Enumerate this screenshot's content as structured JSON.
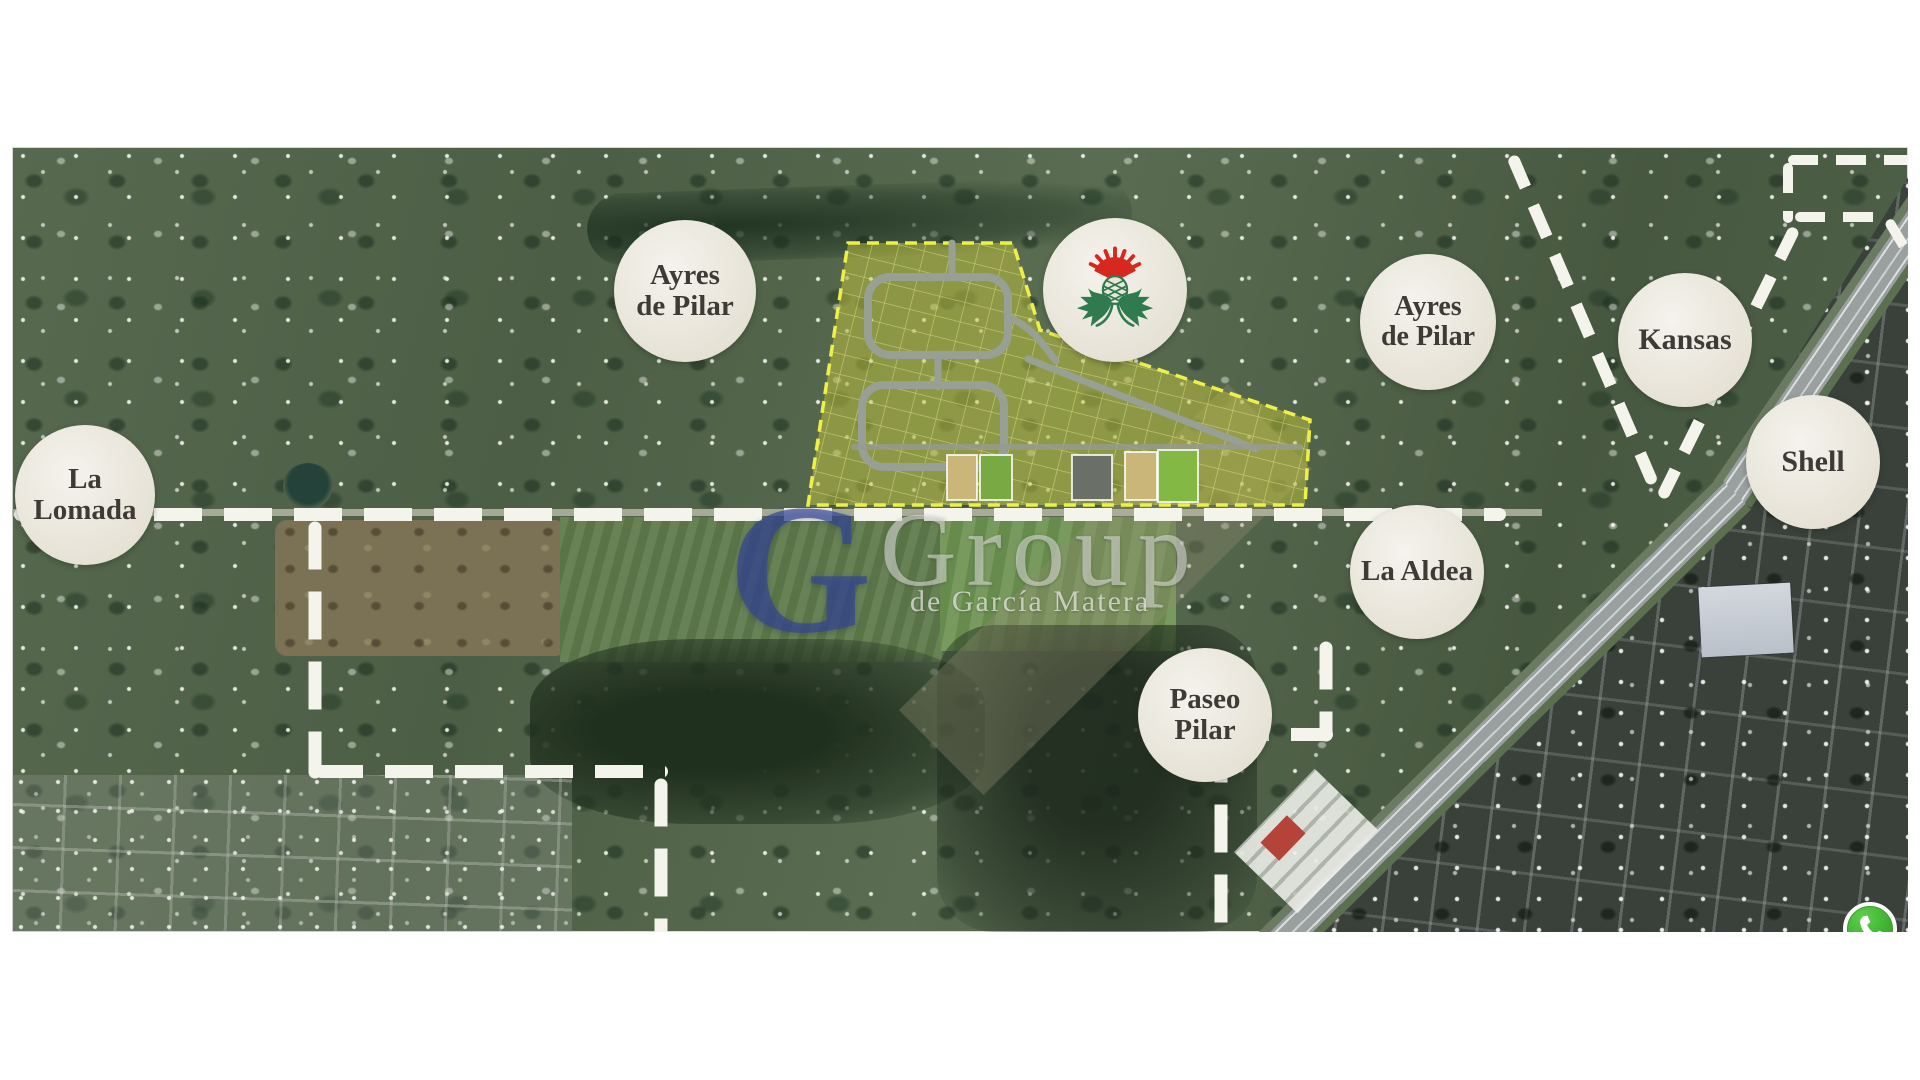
{
  "map_annotations": {
    "labels": {
      "ayres_west": {
        "l1": "Ayres",
        "l2": "de Pilar"
      },
      "ayres_east": {
        "l1": "Ayres",
        "l2": "de Pilar"
      },
      "kansas": {
        "l1": "Kansas",
        "l2": ""
      },
      "shell": {
        "l1": "Shell",
        "l2": ""
      },
      "la_lomada": {
        "l1": "La",
        "l2": "Lomada"
      },
      "la_aldea": {
        "l1": "La Aldea",
        "l2": ""
      },
      "paseo_pilar": {
        "l1": "Paseo",
        "l2": "Pilar"
      }
    },
    "watermark": {
      "initial": "G",
      "word": "Group",
      "subtitle": "de García Matera"
    },
    "icons": {
      "logo_circle": "thistle-emblem",
      "contact": "whatsapp"
    },
    "colors": {
      "circle_bg": "#eae6da",
      "circle_text": "#3c3b36",
      "watermark_blue": "#344496",
      "watermark_white": "#e9e9e4",
      "boundary_dash": "#f4f3ec",
      "highlight_parcel": "#c4c63c",
      "parcel_border": "#eef04a",
      "thistle_red": "#d6281e",
      "thistle_green": "#2f7a4e",
      "whatsapp_green": "#3fae2a"
    }
  }
}
